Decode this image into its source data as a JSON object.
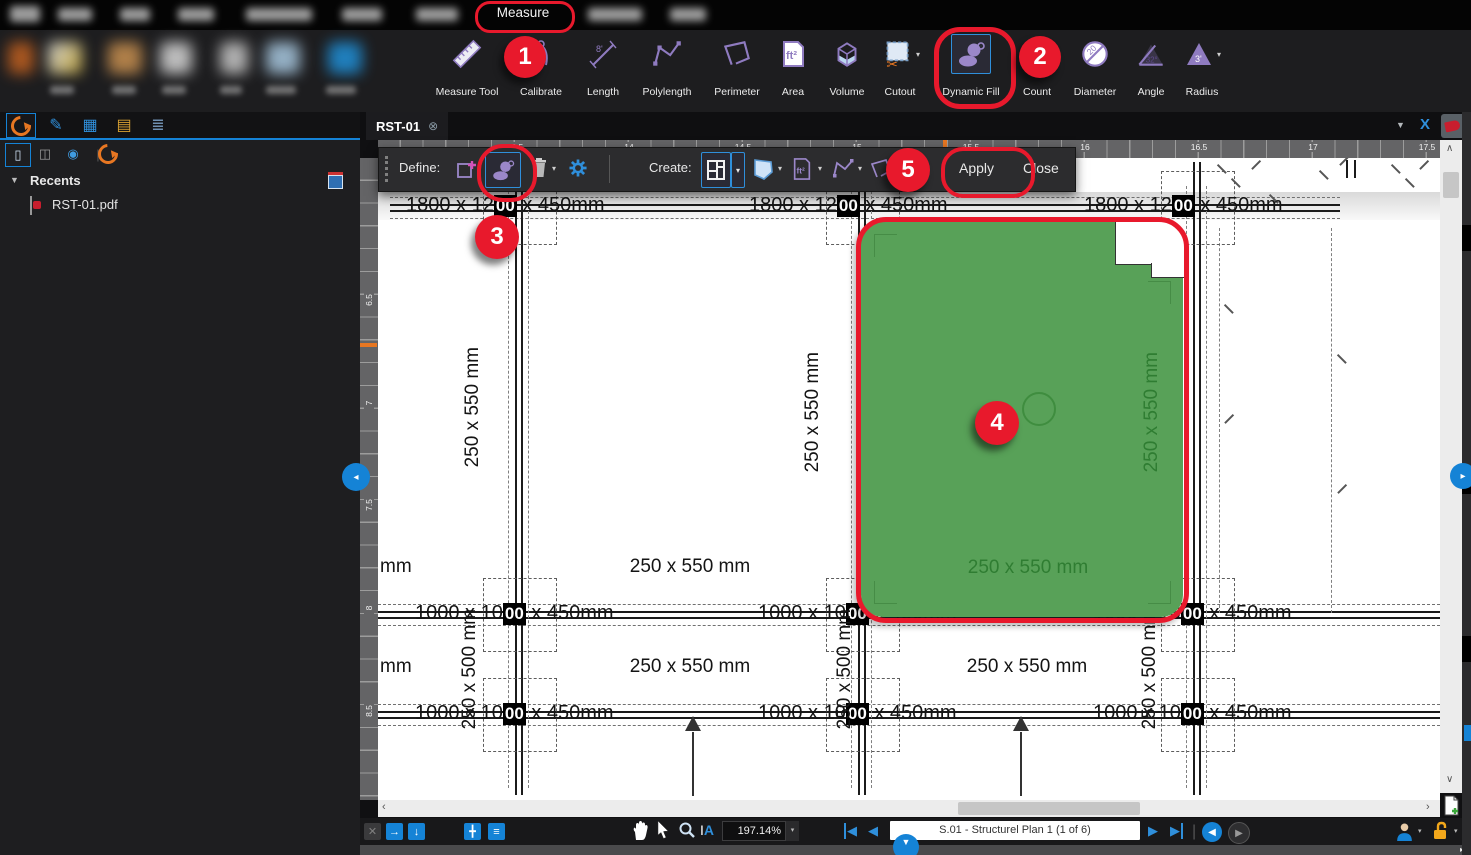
{
  "menu": {
    "active_item": "Measure"
  },
  "ribbon": {
    "tools": [
      {
        "label": "Measure Tool"
      },
      {
        "label": "Calibrate"
      },
      {
        "label": "Length"
      },
      {
        "label": "Polylength"
      },
      {
        "label": "Perimeter"
      },
      {
        "label": "Area"
      },
      {
        "label": "Volume"
      },
      {
        "label": "Cutout"
      },
      {
        "label": "Dynamic Fill"
      },
      {
        "label": "Count"
      },
      {
        "label": "Diameter"
      },
      {
        "label": "Angle"
      },
      {
        "label": "Radius"
      }
    ]
  },
  "sidebar": {
    "recents_label": "Recents",
    "recent_file": "RST-01.pdf"
  },
  "document": {
    "tab_label": "RST-01"
  },
  "fill_toolbar": {
    "define_label": "Define:",
    "create_label": "Create:",
    "apply_label": "Apply",
    "close_label": "Close"
  },
  "rulers": {
    "horizontal": [
      "13.5",
      "14",
      "14.5",
      "15",
      "15.5",
      "16",
      "16.5",
      "17",
      "17.5"
    ],
    "vertical": [
      "6.5",
      "7",
      "7.5",
      "8",
      "8.5"
    ]
  },
  "drawing": {
    "footing_large": {
      "pre": "1800 x 12",
      "column": "00",
      "suf": " x 450mm"
    },
    "footing_small": {
      "pre": "1000 x 10",
      "column": "00",
      "suf": " x 450mm"
    },
    "beam_label": "250 x 550 mm",
    "upstand_label": "250 x 500 mm",
    "edge_partial_label": "mm"
  },
  "dynamic_fill": {
    "area_label": "250 x 550 mm",
    "side_label": "250 x 550 mm"
  },
  "steps": {
    "1": "1",
    "2": "2",
    "3": "3",
    "4": "4",
    "5": "5"
  },
  "statusbar": {
    "zoom_level": "197.14%",
    "page_label": "S.01 - Structurel Plan 1 (1 of 6)"
  },
  "colors": {
    "accent_blue": "#1583d6",
    "annotation_red": "#e8192c",
    "fill_green": "#58a158",
    "tool_purple": "#8f7bc0",
    "marker_orange": "#e87722"
  }
}
